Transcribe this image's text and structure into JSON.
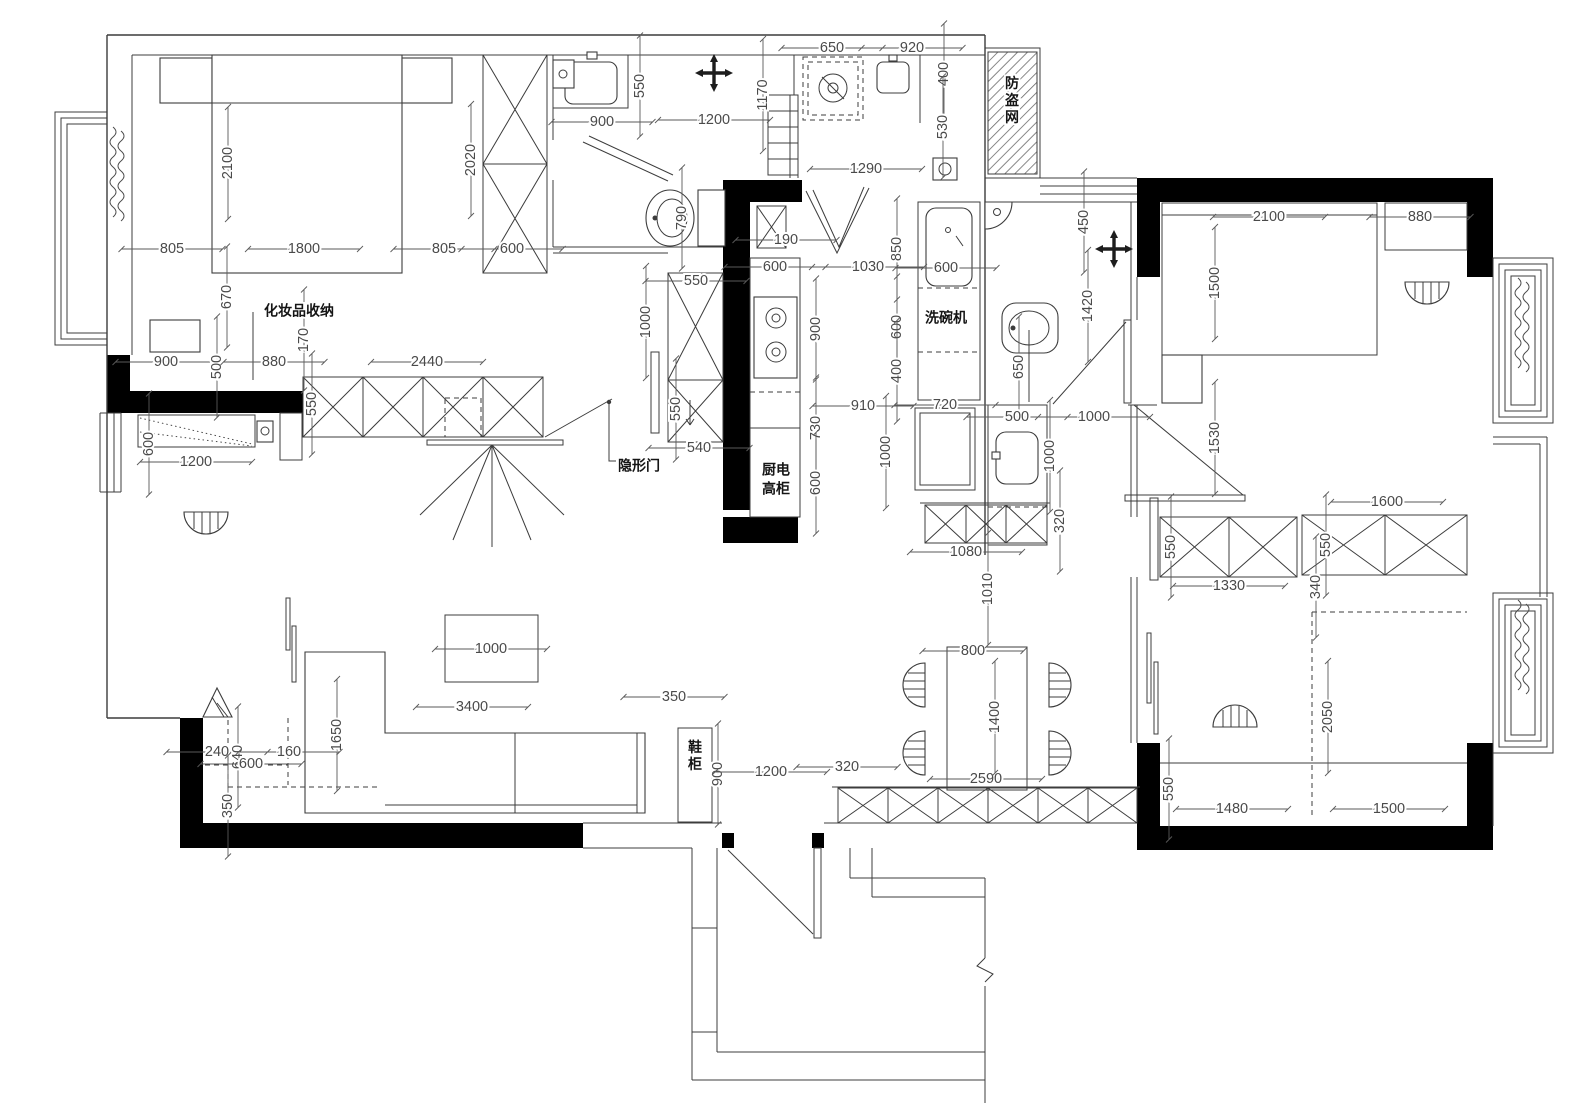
{
  "plan": {
    "colors": {
      "wall": "#000000",
      "line": "#3c3c3c",
      "dim_text": "#4a4a4a",
      "background": "#ffffff"
    },
    "annotations": [
      {
        "text": "化妆品收纳",
        "x": 299,
        "y": 312,
        "vertical": false
      },
      {
        "text": "隐形门",
        "x": 639,
        "y": 467,
        "vertical": false
      },
      {
        "text": "厨电",
        "x": 776,
        "y": 471,
        "vertical": false
      },
      {
        "text": "高柜",
        "x": 776,
        "y": 490,
        "vertical": false
      },
      {
        "text": "洗碗机",
        "x": 946,
        "y": 319,
        "vertical": false
      },
      {
        "text": "鞋柜",
        "x": 695,
        "y": 748,
        "vertical": true
      },
      {
        "text": "防盗网",
        "x": 1012,
        "y": 84,
        "vertical": true
      }
    ],
    "dimensions": [
      {
        "t": "2100",
        "x": 228,
        "y": 163,
        "r": 1
      },
      {
        "t": "2020",
        "x": 471,
        "y": 160,
        "r": 1
      },
      {
        "t": "805",
        "x": 172,
        "y": 249,
        "r": 0
      },
      {
        "t": "1800",
        "x": 304,
        "y": 249,
        "r": 0
      },
      {
        "t": "805",
        "x": 444,
        "y": 249,
        "r": 0
      },
      {
        "t": "600",
        "x": 512,
        "y": 249,
        "r": 0
      },
      {
        "t": "670",
        "x": 227,
        "y": 297,
        "r": 1
      },
      {
        "t": "170",
        "x": 304,
        "y": 340,
        "r": 1
      },
      {
        "t": "900",
        "x": 166,
        "y": 362,
        "r": 0
      },
      {
        "t": "500",
        "x": 217,
        "y": 367,
        "r": 1
      },
      {
        "t": "880",
        "x": 274,
        "y": 362,
        "r": 0
      },
      {
        "t": "2440",
        "x": 427,
        "y": 362,
        "r": 0
      },
      {
        "t": "550",
        "x": 312,
        "y": 404,
        "r": 1
      },
      {
        "t": "600",
        "x": 149,
        "y": 444,
        "r": 1
      },
      {
        "t": "1200",
        "x": 196,
        "y": 462,
        "r": 0
      },
      {
        "t": "550",
        "x": 696,
        "y": 281,
        "r": 0
      },
      {
        "t": "1000",
        "x": 646,
        "y": 322,
        "r": 1
      },
      {
        "t": "550",
        "x": 676,
        "y": 409,
        "r": 1
      },
      {
        "t": "540",
        "x": 699,
        "y": 448,
        "r": 0
      },
      {
        "t": "550",
        "x": 640,
        "y": 86,
        "r": 1
      },
      {
        "t": "900",
        "x": 602,
        "y": 122,
        "r": 0
      },
      {
        "t": "1200",
        "x": 714,
        "y": 120,
        "r": 0
      },
      {
        "t": "1170",
        "x": 763,
        "y": 95,
        "r": 1
      },
      {
        "t": "790",
        "x": 682,
        "y": 218,
        "r": 1
      },
      {
        "t": "650",
        "x": 832,
        "y": 48,
        "r": 0
      },
      {
        "t": "920",
        "x": 912,
        "y": 48,
        "r": 0
      },
      {
        "t": "400",
        "x": 944,
        "y": 74,
        "r": 1
      },
      {
        "t": "530",
        "x": 943,
        "y": 127,
        "r": 1
      },
      {
        "t": "1290",
        "x": 866,
        "y": 169,
        "r": 0
      },
      {
        "t": "190",
        "x": 786,
        "y": 240,
        "r": 0
      },
      {
        "t": "600",
        "x": 775,
        "y": 267,
        "r": 0
      },
      {
        "t": "1030",
        "x": 868,
        "y": 267,
        "r": 0
      },
      {
        "t": "850",
        "x": 897,
        "y": 249,
        "r": 1
      },
      {
        "t": "600",
        "x": 897,
        "y": 327,
        "r": 1
      },
      {
        "t": "400",
        "x": 897,
        "y": 371,
        "r": 1
      },
      {
        "t": "900",
        "x": 816,
        "y": 329,
        "r": 1
      },
      {
        "t": "730",
        "x": 816,
        "y": 428,
        "r": 1
      },
      {
        "t": "600",
        "x": 816,
        "y": 483,
        "r": 1
      },
      {
        "t": "910",
        "x": 863,
        "y": 406,
        "r": 0
      },
      {
        "t": "720",
        "x": 945,
        "y": 405,
        "r": 0
      },
      {
        "t": "1000",
        "x": 886,
        "y": 452,
        "r": 1
      },
      {
        "t": "1080",
        "x": 966,
        "y": 552,
        "r": 0
      },
      {
        "t": "600",
        "x": 946,
        "y": 268,
        "r": 0
      },
      {
        "t": "450",
        "x": 1084,
        "y": 222,
        "r": 1
      },
      {
        "t": "1420",
        "x": 1088,
        "y": 306,
        "r": 1
      },
      {
        "t": "650",
        "x": 1019,
        "y": 367,
        "r": 1
      },
      {
        "t": "500",
        "x": 1017,
        "y": 417,
        "r": 0
      },
      {
        "t": "1000",
        "x": 1094,
        "y": 417,
        "r": 0
      },
      {
        "t": "1000",
        "x": 1050,
        "y": 456,
        "r": 1
      },
      {
        "t": "320",
        "x": 1060,
        "y": 521,
        "r": 1
      },
      {
        "t": "2100",
        "x": 1269,
        "y": 217,
        "r": 0
      },
      {
        "t": "880",
        "x": 1420,
        "y": 217,
        "r": 0
      },
      {
        "t": "1500",
        "x": 1215,
        "y": 283,
        "r": 1
      },
      {
        "t": "1530",
        "x": 1215,
        "y": 438,
        "r": 1
      },
      {
        "t": "1600",
        "x": 1387,
        "y": 502,
        "r": 0
      },
      {
        "t": "550",
        "x": 1171,
        "y": 547,
        "r": 1
      },
      {
        "t": "1330",
        "x": 1229,
        "y": 586,
        "r": 0
      },
      {
        "t": "550",
        "x": 1326,
        "y": 545,
        "r": 1
      },
      {
        "t": "340",
        "x": 1316,
        "y": 587,
        "r": 1
      },
      {
        "t": "2050",
        "x": 1328,
        "y": 717,
        "r": 1
      },
      {
        "t": "550",
        "x": 1169,
        "y": 789,
        "r": 1
      },
      {
        "t": "1480",
        "x": 1232,
        "y": 809,
        "r": 0
      },
      {
        "t": "1500",
        "x": 1389,
        "y": 809,
        "r": 0
      },
      {
        "t": "1000",
        "x": 491,
        "y": 649,
        "r": 0
      },
      {
        "t": "3400",
        "x": 472,
        "y": 707,
        "r": 0
      },
      {
        "t": "350",
        "x": 674,
        "y": 697,
        "r": 0
      },
      {
        "t": "1650",
        "x": 337,
        "y": 735,
        "r": 1
      },
      {
        "t": "240",
        "x": 217,
        "y": 752,
        "r": 0
      },
      {
        "t": "640",
        "x": 238,
        "y": 757,
        "r": 1
      },
      {
        "t": "600",
        "x": 251,
        "y": 764,
        "r": 0
      },
      {
        "t": "160",
        "x": 289,
        "y": 752,
        "r": 0
      },
      {
        "t": "350",
        "x": 228,
        "y": 806,
        "r": 1
      },
      {
        "t": "900",
        "x": 718,
        "y": 774,
        "r": 1
      },
      {
        "t": "1200",
        "x": 771,
        "y": 772,
        "r": 0
      },
      {
        "t": "320",
        "x": 847,
        "y": 767,
        "r": 0
      },
      {
        "t": "2590",
        "x": 986,
        "y": 779,
        "r": 0
      },
      {
        "t": "800",
        "x": 973,
        "y": 651,
        "r": 0
      },
      {
        "t": "1400",
        "x": 995,
        "y": 717,
        "r": 1
      },
      {
        "t": "1010",
        "x": 988,
        "y": 589,
        "r": 1
      }
    ]
  }
}
